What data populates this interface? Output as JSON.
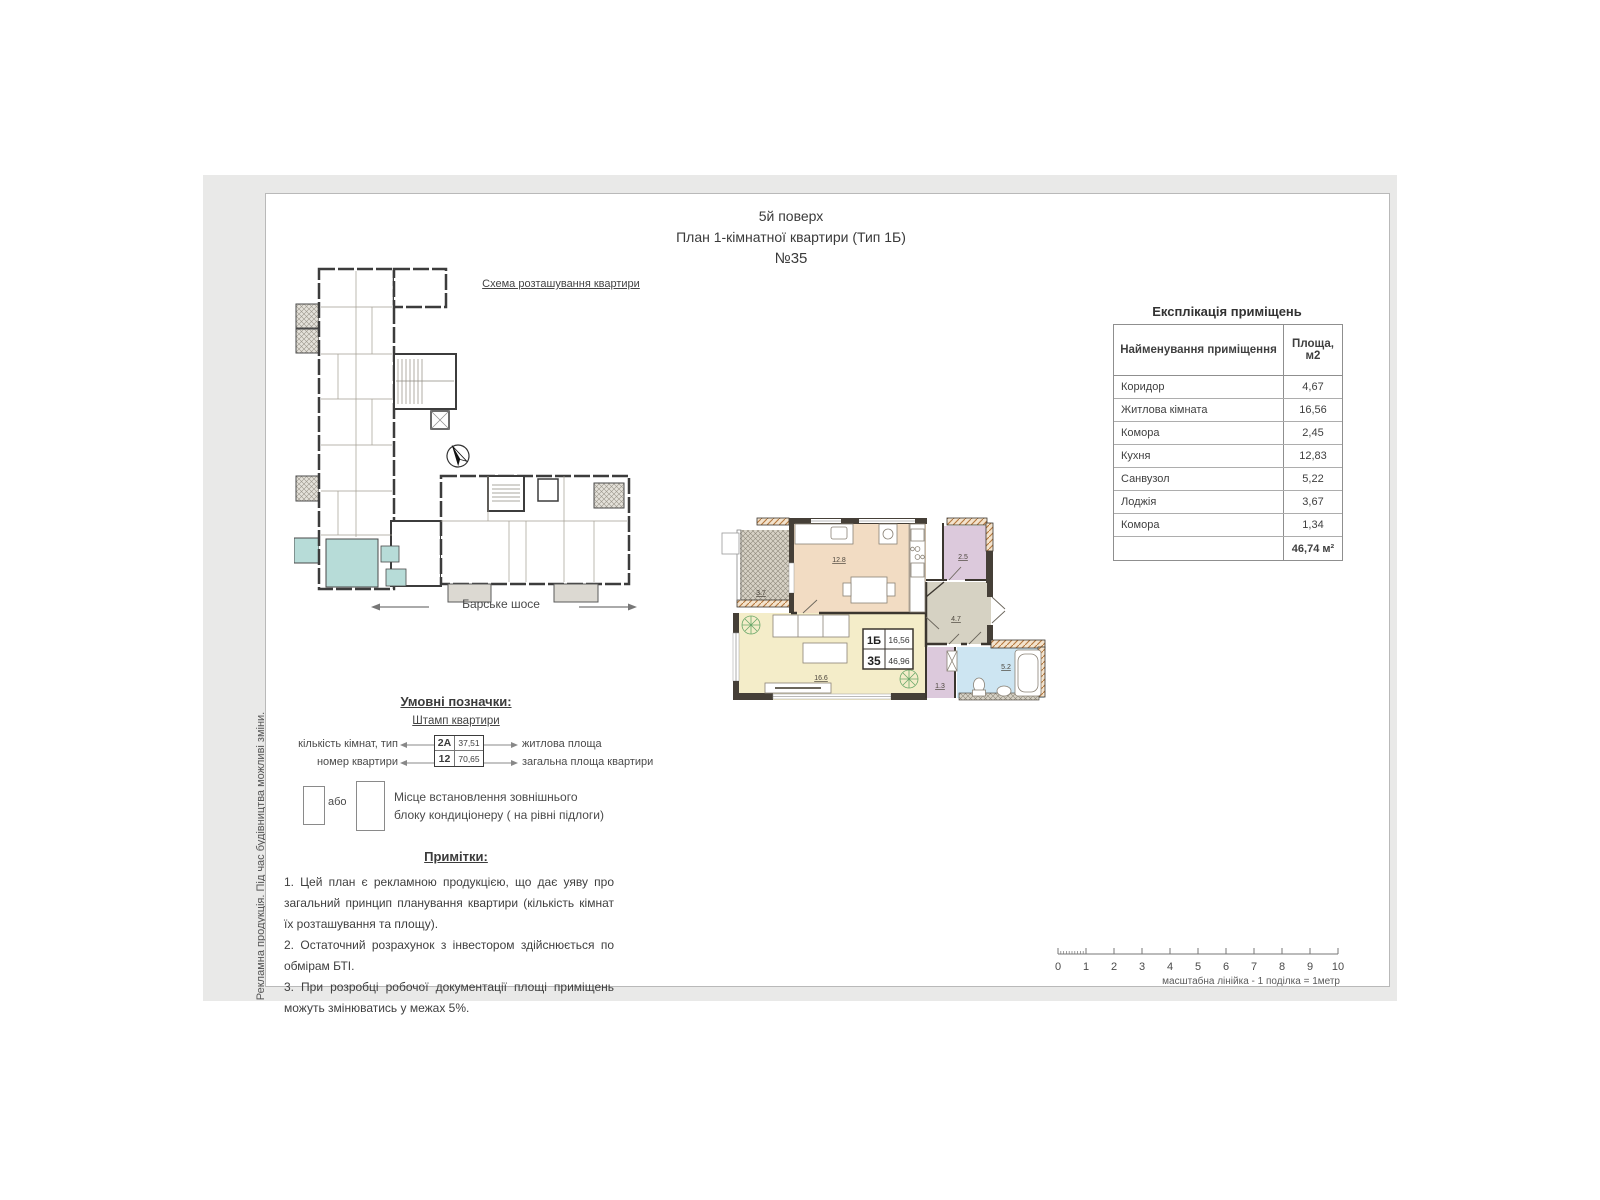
{
  "page": {
    "title_line1": "5й поверх",
    "title_line2": "План 1-кімнатної квартири (Тип 1Б)",
    "title_line3": "№35",
    "side_note": "Рекламна продукція. Під час будівництва можливі зміни."
  },
  "scheme": {
    "label": "Схема розташування квартири",
    "street": "Барське шосе"
  },
  "table": {
    "title": "Експлікація приміщень",
    "col1": "Найменування приміщення",
    "col2": "Площа, м2",
    "rows": [
      {
        "name": "Коридор",
        "area": "4,67"
      },
      {
        "name": "Житлова кімната",
        "area": "16,56"
      },
      {
        "name": "Комора",
        "area": "2,45"
      },
      {
        "name": "Кухня",
        "area": "12,83"
      },
      {
        "name": "Санвузол",
        "area": "5,22"
      },
      {
        "name": "Лоджія",
        "area": "3,67"
      },
      {
        "name": "Комора",
        "area": "1,34"
      }
    ],
    "total": "46,74 м²"
  },
  "plan": {
    "stamp": {
      "type": "1Б",
      "living_area": "16,56",
      "number": "35",
      "total_area": "46,96"
    },
    "rooms": {
      "loggia": "3.7",
      "kitchen": "12.8",
      "storage_top": "2.5",
      "corridor": "4.7",
      "living": "16.6",
      "storage_small": "1.3",
      "bathroom": "5.2"
    }
  },
  "legend": {
    "title": "Умовні позначки:",
    "stamp_label": "Штамп квартири",
    "left1": "кількість кімнат, тип",
    "left2": "номер квартири",
    "right1": "житлова площа",
    "right2": "загальна площа квартири",
    "sample_type": "2А",
    "sample_living": "37,51",
    "sample_number": "12",
    "sample_total": "70,65",
    "or_label": "або",
    "ac_line1": "Місце встановлення зовнішнього",
    "ac_line2": "блоку кондиціонеру ( на рівні підлоги)"
  },
  "notes": {
    "title": "Примітки:",
    "items": [
      "1. Цей план є рекламною продукцією, що дає уяву про загальний принцип планування квартири (кількість кімнат їх розташування та площу).",
      "2. Остаточний розрахунок з інвестором здійснюється по обмірам БТІ.",
      "3. При розробці робочої документації площі приміщень можуть змінюватись у межах 5%."
    ]
  },
  "ruler": {
    "ticks": [
      "0",
      "1",
      "2",
      "3",
      "4",
      "5",
      "6",
      "7",
      "8",
      "9",
      "10"
    ],
    "label": "масштабна лінійка - 1 поділка = 1метр"
  },
  "colors": {
    "sheet_bg": "#e9e9e8",
    "highlight_teal": "#b7dcd8",
    "kitchen_fill": "#f2dcc3",
    "living_fill": "#f4edc9",
    "bath_fill": "#cde5f2",
    "storage_fill": "#dcc9dc",
    "corridor_fill": "#d6d2c3",
    "wall": "#3b362f",
    "wall_hatch": "#b5773c"
  }
}
